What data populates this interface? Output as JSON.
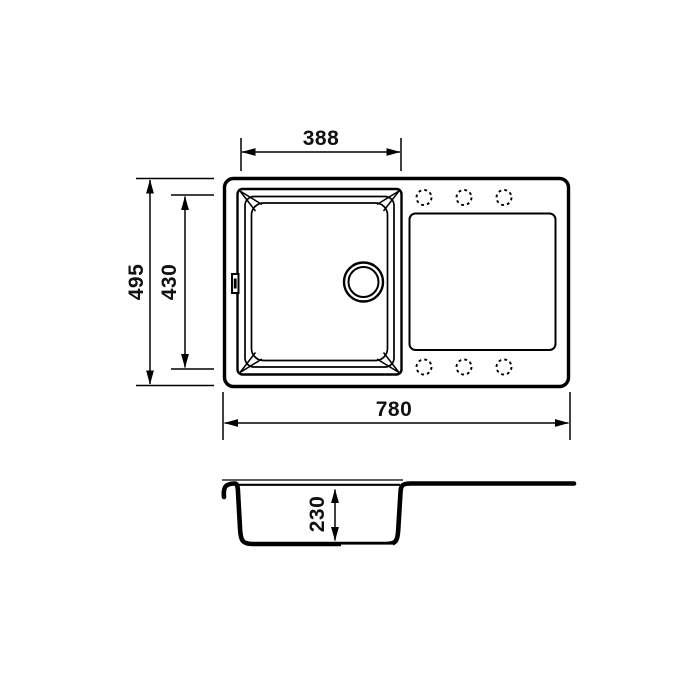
{
  "colors": {
    "line": "#000000",
    "background": "#ffffff"
  },
  "dimensions": {
    "bowl_width": "388",
    "overall_depth": "495",
    "bowl_inner_depth": "430",
    "overall_width": "780",
    "bowl_height": "230"
  },
  "features": {
    "tap_hole_count": 6,
    "views": "top view and cross-section of inset sink with drainboard"
  }
}
